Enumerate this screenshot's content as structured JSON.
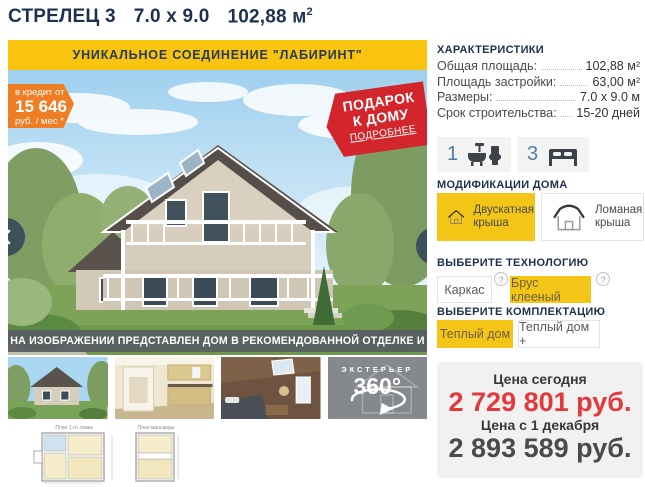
{
  "title": {
    "name": "СТРЕЛЕЦ 3",
    "dimensions": "7.0 х 9.0",
    "area": "102,88 м",
    "area_sup": "2"
  },
  "hero": {
    "banner": "УНИКАЛЬНОЕ СОЕДИНЕНИЕ \"ЛАБИРИНТ\"",
    "credit": {
      "prefix": "в кредит от",
      "amount": "15 646",
      "suffix": "руб. / мес *"
    },
    "gift": {
      "line1": "ПОДАРОК",
      "line2": "К ДОМУ",
      "more": "ПОДРОБНЕЕ"
    },
    "caption": "НА ИЗОБРАЖЕНИИ ПРЕДСТАВЛЕН ДОМ В РЕКОМЕНДОВАННОЙ ОТДЕЛКЕ И КОНФИГУРАЦИИ"
  },
  "gallery": {
    "view360_label": "ЭКСТЕРЬЕР",
    "view360_value": "360°",
    "plan1_title": "План 1-го этажа",
    "plan2_title": "План мансарды"
  },
  "characteristics": {
    "header": "ХАРАКТЕРИСТИКИ",
    "rows": [
      {
        "label": "Общая площадь:",
        "value": "102,88 м²"
      },
      {
        "label": "Площадь застройки:",
        "value": "63,00 м²"
      },
      {
        "label": "Размеры:",
        "value": "7.0 х 9.0 м"
      },
      {
        "label": "Срок строительства:",
        "value": "15-20 дней"
      }
    ]
  },
  "features": {
    "bathrooms": "1",
    "bedrooms": "3"
  },
  "modifications": {
    "header": "МОДИФИКАЦИИ ДОМА",
    "options": [
      {
        "line1": "Двускатная",
        "line2": "крыша",
        "selected": true
      },
      {
        "line1": "Ломаная",
        "line2": "крыша",
        "selected": false
      }
    ]
  },
  "technology": {
    "header": "ВЫБЕРИТЕ ТЕХНОЛОГИЮ",
    "options": [
      {
        "label": "Каркас",
        "selected": false
      },
      {
        "label": "Брус клееный",
        "selected": true
      }
    ],
    "help_icon": "?"
  },
  "equipment": {
    "header": "ВЫБЕРИТЕ КОМПЛЕКТАЦИЮ",
    "options": [
      {
        "label": "Теплый дом",
        "selected": true
      },
      {
        "label": "Теплый дом +",
        "selected": false
      }
    ]
  },
  "pricing": {
    "today_label": "Цена сегодня",
    "today_price": "2 729 801 руб.",
    "later_label": "Цена с 1 декабря",
    "later_price": "2 893 589 руб."
  },
  "colors": {
    "accent_yellow": "#f3c516",
    "brand_navy": "#1d3050",
    "price_red": "#e23a3c",
    "badge_orange": "#ef7d24",
    "ribbon_red": "#d3262c",
    "number_blue": "#4d7ea8"
  }
}
